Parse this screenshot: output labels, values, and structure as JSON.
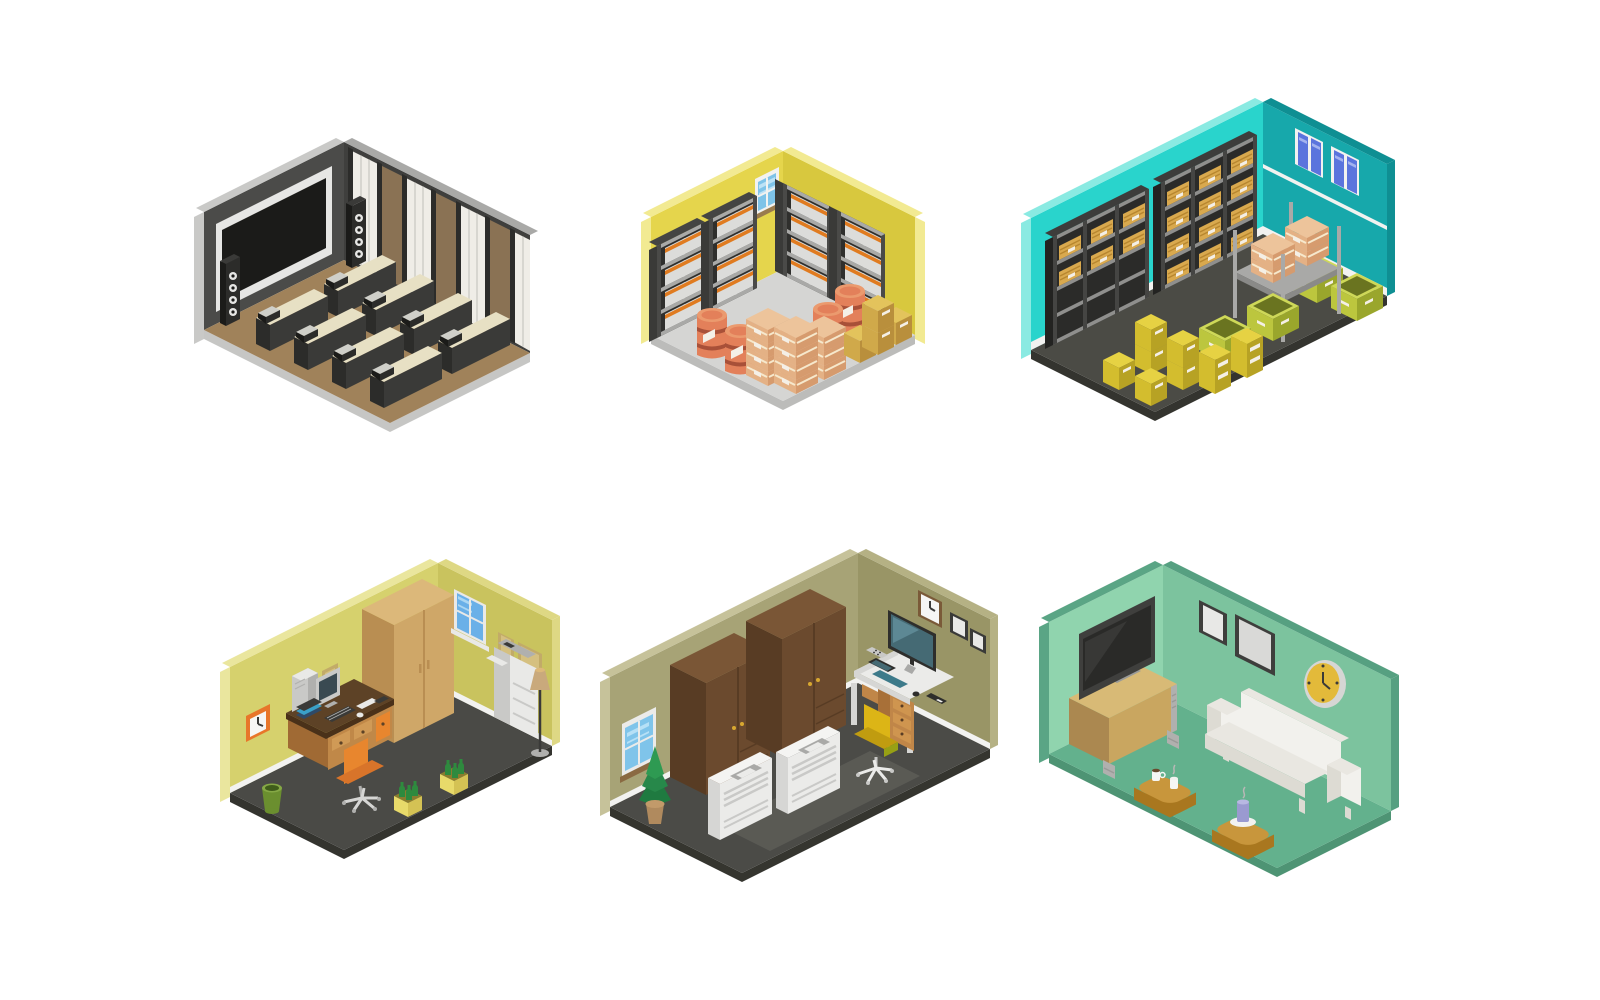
{
  "page": {
    "background": "#ffffff",
    "description": "Set of six isometric room interior illustrations arranged in a 2x3 grid on a white background"
  },
  "rooms": [
    {
      "id": "home-theater",
      "label": "Home theater room with projection screen, speaker towers, bench seat rows and curtain wall",
      "grid": {
        "row": 1,
        "col": 1
      },
      "objects": [
        "projection-screen",
        "speaker-towers",
        "theater-bench-rows",
        "curtain-and-panel-wall"
      ],
      "colors": {
        "wallL": "#4b4b49",
        "wallR": "#3f3f3d",
        "edgeL": "#c9c9c7",
        "edgeR": "#a9a9a7",
        "floor": "#a0825a",
        "base": "#c6c6c4",
        "white1": "#e6e6e4",
        "dark1": "#3a3a38",
        "dark2": "#2c2c2a",
        "dark3": "#1b1b19",
        "curtain": "#efede7",
        "gray1": "#cfcfc9",
        "panel": "#8a7254",
        "benchTop": "#e7e0c4"
      }
    },
    {
      "id": "storage-room",
      "label": "Yellow storage room with shelving units, white boxes, barrels and cardboard crate stacks",
      "grid": {
        "row": 1,
        "col": 2
      },
      "objects": [
        "wall-shelving-units",
        "stacked-white-boxes",
        "window",
        "orange-barrels",
        "cardboard-crate-stacks",
        "yellow-boxes"
      ],
      "colors": {
        "wallL": "#e5d54c",
        "wallR": "#d8c83e",
        "edgeL": "#f2ea92",
        "floor": "#d5d5d3",
        "base": "#bcbcba",
        "shelf": "#2f2f2d",
        "shelfSide": "#3a3a38",
        "shelfBoard": "#a9a9a7",
        "shelfPost": "#4a4a48",
        "shelfTop": "#454543",
        "boxW": "#dcdcda",
        "boxBand": "#e07b20",
        "labelW": "#f4efe6",
        "white1": "#f2f2f0",
        "glass": "#7ec3e8",
        "glassHi": "#bce2f6",
        "sill": "#9a7b4e",
        "barrel": "#e3805a",
        "barrelTop": "#eb9a6e",
        "barrelBand": "#a85038",
        "crateT": "#edc49b",
        "crateL": "#e4b185",
        "crateR": "#d69b6e",
        "crateStripe": "#f6e8cc",
        "yT": "#e3c35c",
        "yL": "#d0a94a",
        "yR": "#b98f3c"
      }
    },
    {
      "id": "warehouse",
      "label": "Teal warehouse with storage racks, windows, pallet platform, bins and yellow box stacks",
      "grid": {
        "row": 1,
        "col": 3
      },
      "objects": [
        "storage-racks-with-boxes",
        "two-windows",
        "pallet-platform-with-crates",
        "yellow-bins",
        "yellow-box-stacks"
      ],
      "colors": {
        "wallL": "#29d4cc",
        "wallR": "#17a8ab",
        "edgeL": "#8aeae2",
        "edgeR": "#0f8f93",
        "floor": "#4b4b45",
        "base": "#34342f",
        "baseboard": "#f2f2f0",
        "shelf": "#2b2b29",
        "shelfSide": "#232321",
        "shelfBoard": "#8f8f8d",
        "shelfPost": "#454543",
        "shelfTop": "#3d3d3b",
        "boxT": "#d9a94e",
        "boxTstripe": "#b8862f",
        "labelW": "#f4efe6",
        "white1": "#f2f2f0",
        "glass": "#5b74dd",
        "glassHi": "#a3b2ef",
        "metal": "#a9a9a7",
        "metalD": "#8a8a88",
        "binL": "#bcc63e",
        "binR": "#9aa62c",
        "binIn": "#6a7420",
        "binRim": "#ced858",
        "crateT": "#edc49b",
        "crateL": "#e4b185",
        "crateR": "#d69b6e",
        "crateStripe": "#f6e8cc",
        "yT": "#e6d243",
        "yL": "#d3bd2e",
        "yR": "#b7a224"
      }
    },
    {
      "id": "home-office",
      "label": "Home office with desk computer, orange chair, wardrobe, copier, floor lamp and bottle planters",
      "grid": {
        "row": 2,
        "col": 1
      },
      "objects": [
        "wall-clock",
        "picture-frames",
        "desk-with-computer",
        "office-chair",
        "trash-bin",
        "wardrobe",
        "window",
        "copier",
        "floor-lamp",
        "bottle-planters"
      ],
      "colors": {
        "wallL": "#d6d16d",
        "wallR": "#c9c35e",
        "edgeL": "#eae69e",
        "edgeR": "#ded884",
        "floor": "#4a4a46",
        "base": "#34342f",
        "baseboard": "#f2f2f0",
        "clockFrame": "#e8762a",
        "clockFace": "#f6f6f4",
        "hand": "#3a3a38",
        "wood1": "#5d4226",
        "wood1D": "#4a3119",
        "wood2": "#c08848",
        "wood2L": "#d09a56",
        "wood2D": "#a06a34",
        "wood3": "#cfa768",
        "woodD": "#b98e52",
        "woodTop": "#dcb87a",
        "accent": "#e8862e",
        "accent2": "#d8742a",
        "white1": "#e9e9e7",
        "white2": "#d6d6d4",
        "white3": "#f4f4f2",
        "gray1": "#c9c9c7",
        "gray2": "#b0b0ae",
        "dark1": "#3a3a38",
        "glass": "#6ab0e8",
        "glassHi": "#aad6f2",
        "frameTan": "#c2ab68",
        "frameTanIn": "#d5c080",
        "green1": "#6b8f2f",
        "green2": "#85a845",
        "greenD": "#3f5c1a",
        "bottle": "#2e8a3e",
        "planter": "#e8da6a",
        "planterR": "#d4c254",
        "planterIn": "#8a7c2e",
        "lamp": "#c9a97c",
        "screenB": "#3a4a52",
        "book1": "#2e4a68",
        "book2": "#3aa0c8"
      }
    },
    {
      "id": "office",
      "label": "Olive office with window, plant, two wardrobes, air-conditioner units, monitor desk and yellow chair",
      "grid": {
        "row": 2,
        "col": 2
      },
      "objects": [
        "window",
        "potted-plant",
        "two-wardrobes",
        "air-conditioner-units",
        "desk-with-monitor",
        "office-chair",
        "wall-clock",
        "picture-frames"
      ],
      "colors": {
        "wallL": "#a7a376",
        "wallR": "#999566",
        "edgeL": "#c6c29a",
        "edgeR": "#b5b184",
        "floor": "#4b4b47",
        "floor2": "#5a5a54",
        "base": "#35352f",
        "baseboard": "#f2f2f0",
        "white1": "#ebebe9",
        "white2": "#d6d6d4",
        "white3": "#f4f4f2",
        "gray1": "#c9c9c7",
        "gray2": "#a9a9a7",
        "dark1": "#2e2e2c",
        "glass": "#7fc4ea",
        "glassHi": "#b6e0f6",
        "sill": "#8a6a42",
        "wood1": "#6b4a2e",
        "woodD": "#583c24",
        "woodTop": "#7a5636",
        "knob": "#d8a830",
        "wood2": "#c08648",
        "wood2L": "#cf954f",
        "wood2D": "#a87038",
        "screenTeal": "#456a74",
        "screenHi": "#5d8894",
        "kbd": "#3d7a8a",
        "chair1": "#dcb516",
        "chair2": "#c09c10",
        "chair3": "#97a014",
        "clockFrame": "#7a5a38",
        "clockFace": "#f6f6f4",
        "hand": "#3a3a38",
        "frameD": "#3a3a38",
        "frameIn": "#e8e8e6",
        "plant1": "#2e9a52",
        "plant2": "#27884a",
        "plant3": "#1f7a40",
        "pot": "#b08a5e",
        "potRim": "#c29a6a"
      }
    },
    {
      "id": "living-room",
      "label": "Mint green living room with TV on sideboard, picture frames, wall clock, white sofa and ottoman tables",
      "grid": {
        "row": 2,
        "col": 3
      },
      "objects": [
        "tv-on-sideboard",
        "picture-frames",
        "wall-clock",
        "sofa",
        "ottoman-tables",
        "coffee-mugs",
        "candle"
      ],
      "colors": {
        "wallL": "#90d4ae",
        "wallR": "#7cc39e",
        "edgeL": "#5aa585",
        "edgeR": "#56a081",
        "floor": "#63b18d",
        "base": "#4e9474",
        "wood3": "#c9a660",
        "woodTop": "#d8ba76",
        "woodD": "#ab8850",
        "gray1": "#9a9a98",
        "gray2": "#b0b0ae",
        "tvFrame": "#3f3f3d",
        "tvScreen": "#2a2a28",
        "tvSheen": "#383836",
        "frameD": "#3e3e3c",
        "frameIn": "#e8e8e6",
        "frameIn2": "#d9d9d7",
        "clockRim": "#d6d6d4",
        "clockFace": "#e3ba3a",
        "hand": "#3a3a38",
        "sofa1": "#f2f1ed",
        "sofa2": "#e9e7e1",
        "sofa3": "#dddbd3",
        "ottoTop": "#c8963c",
        "ottoSide": "#a9771f",
        "mug": "#f6f6f4",
        "coffee": "#6a4a2e",
        "candle": "#9a9ad0",
        "candleTop": "#b8b8e2",
        "plate": "#f2f2f0",
        "steam": "#b8b8b6"
      }
    }
  ]
}
